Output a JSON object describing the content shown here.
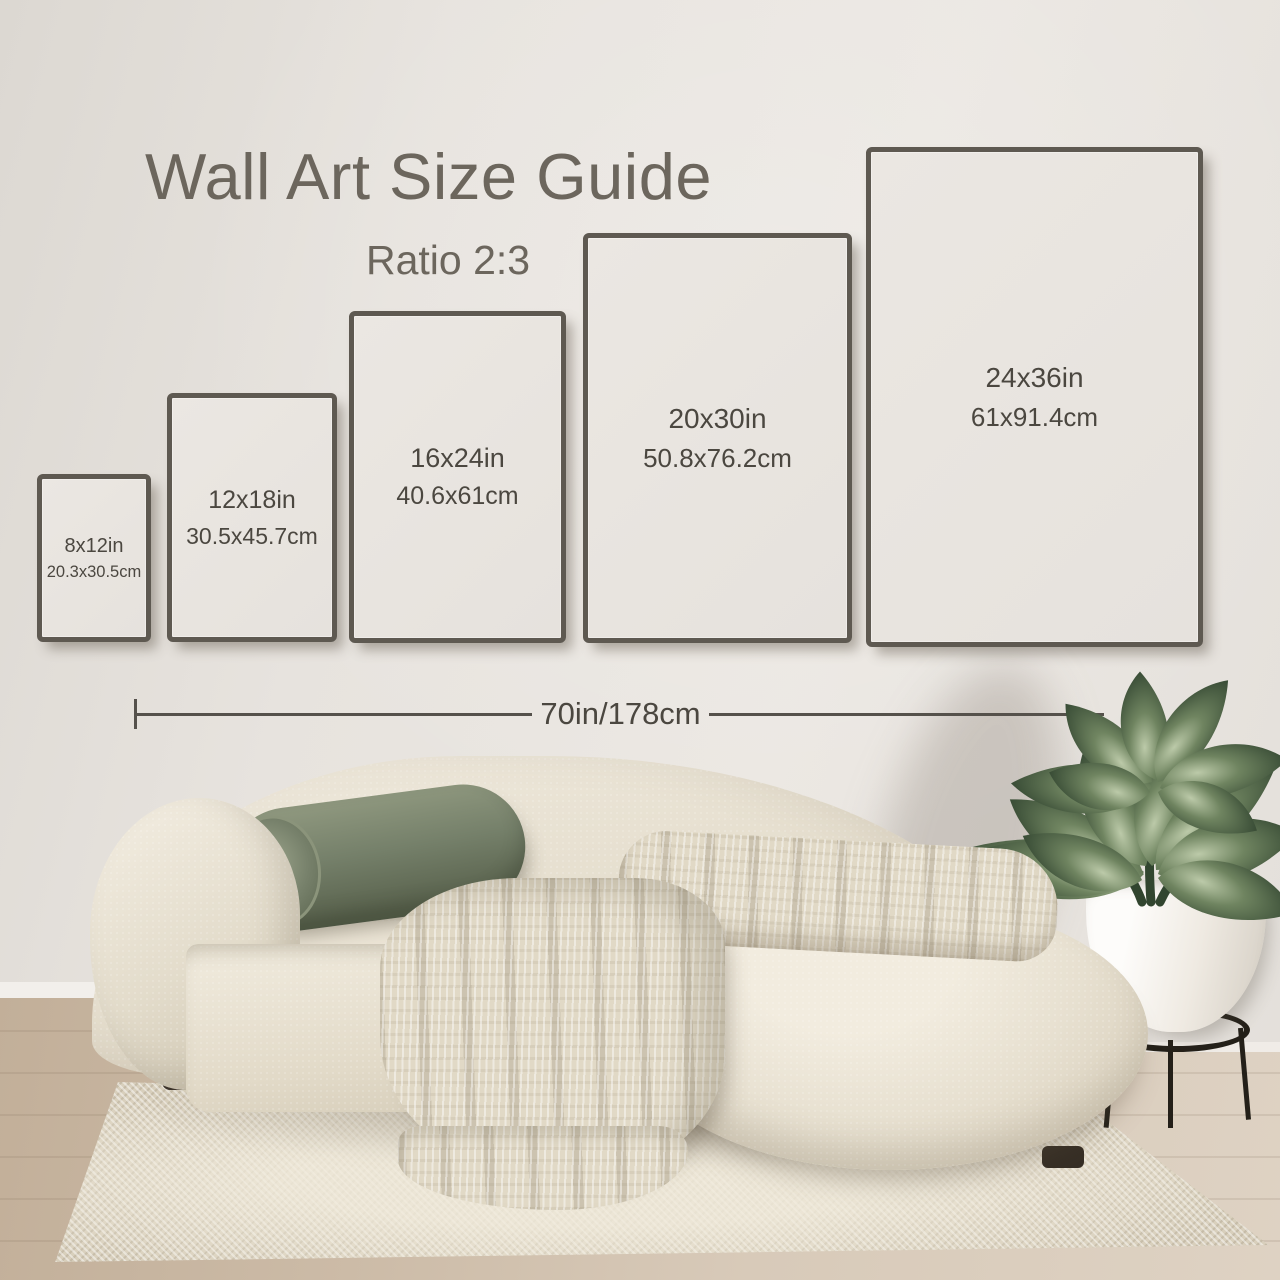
{
  "title": "Wall Art Size Guide",
  "subtitle": "Ratio 2:3",
  "frames": [
    {
      "inches": "8x12in",
      "cm": "20.3x30.5cm"
    },
    {
      "inches": "12x18in",
      "cm": "30.5x45.7cm"
    },
    {
      "inches": "16x24in",
      "cm": "40.6x61cm"
    },
    {
      "inches": "20x30in",
      "cm": "50.8x76.2cm"
    },
    {
      "inches": "24x36in",
      "cm": "61x91.4cm"
    }
  ],
  "measurement": {
    "label": "70in/178cm"
  },
  "colors": {
    "wall": "#e8e4df",
    "frame_border": "#5e5951",
    "title_text": "#6c665d",
    "label_text": "#4b4740",
    "measure_line": "#55514b",
    "sofa": "#e7e0d0",
    "pillow_green": "#75806a",
    "blanket": "#e1d9c6",
    "leaf_dark": "#2c3f2c",
    "leaf_light": "#b7c6a6",
    "pot_white": "#f6f4f0",
    "stand_black": "#242019",
    "rug": "#d8cfbc",
    "floor_wood": "#ccbba7"
  },
  "scene": {
    "objects": [
      "sofa",
      "bolster-pillow",
      "throw-blanket",
      "potted-plant",
      "plant-pot",
      "plant-stand",
      "rug",
      "wood-floor",
      "wall"
    ]
  }
}
